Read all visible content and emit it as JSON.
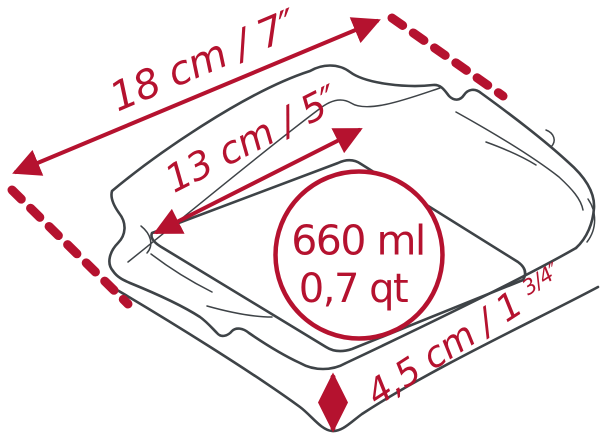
{
  "diagram": {
    "subject": "square-baking-dish-dimensions",
    "colors": {
      "accent_red": "#B5122F",
      "line_gray": "#3E4347",
      "background": "#FFFFFF"
    },
    "labels": {
      "outer_width": "18 cm / 7″",
      "inner_width": "13 cm / 5″",
      "height_main": "4,5 cm / 1",
      "height_fraction": "3/4",
      "height_unit": "″",
      "volume_ml": "660 ml",
      "volume_qt": "0,7 qt"
    }
  }
}
